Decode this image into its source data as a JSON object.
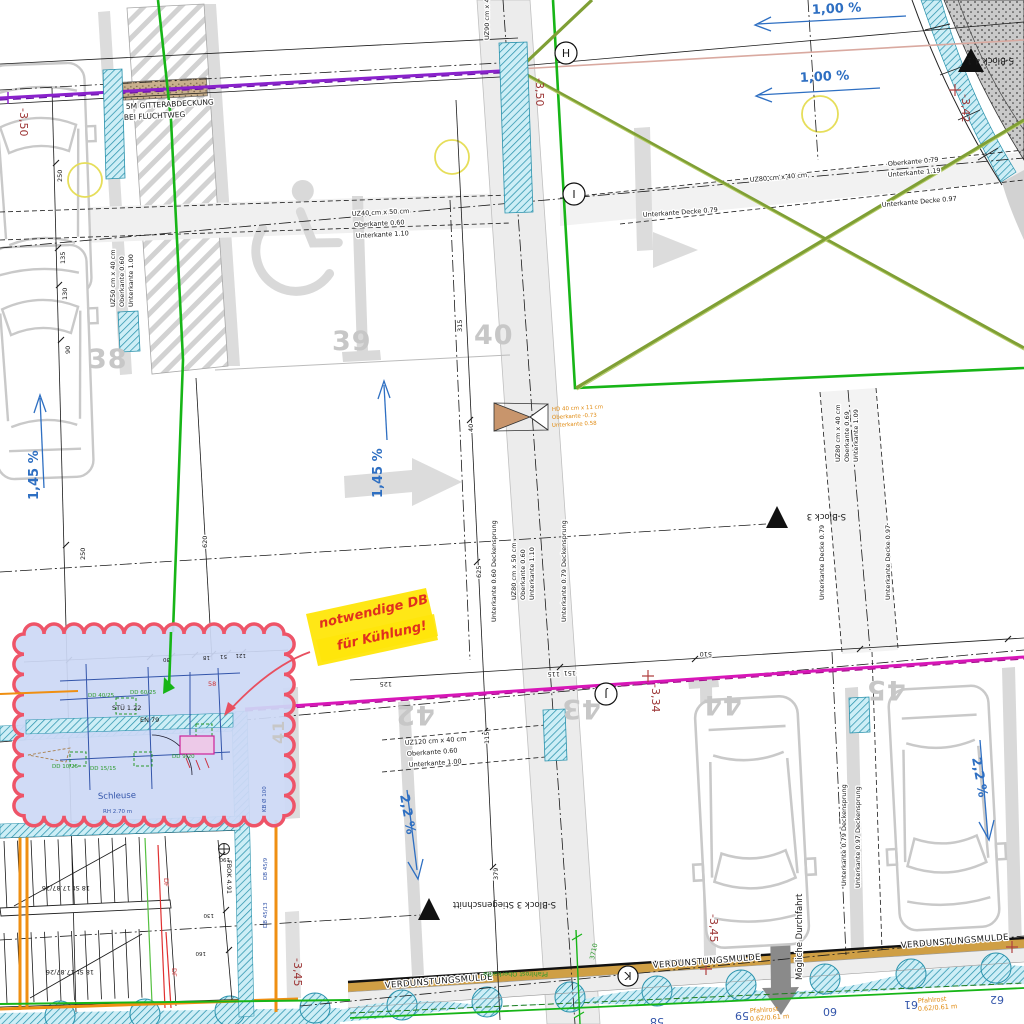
{
  "labels": {
    "gitter1": "5M GITTERABDECKUNG",
    "gitter2": "BEI FLUCHTWEG",
    "slope100a": "1,00 %",
    "slope100b": "1,00 %",
    "slope145a": "1,45 %",
    "slope145b": "1,45 %",
    "slope22a": "2,2 %",
    "slope22b": "2,2 %",
    "lvl350a": "-3,50",
    "lvl350b": "-3,50",
    "lvl342": "-3,42",
    "lvl334": "-3,34",
    "lvl345a": "-3,45",
    "lvl345b": "-3,45",
    "sblock3": "S-Block 3",
    "sblock41": "S-Block 4.1",
    "sblock3st": "S-Block 3 Stiegenschnitt",
    "gridH": "H",
    "gridI": "I",
    "gridJ": "J",
    "gridK": "K",
    "mulde": "VERDUNSTUNGSMULDE",
    "durchfahrt": "Mögliche Durchfahrt",
    "pfahlrost": "Pfahlrost",
    "pfahlrost_dim": "0.62/0.61 m",
    "pfahlrost_ok": "Pfahlrost Oberkante"
  },
  "spots": {
    "n38": "38",
    "n39": "39",
    "n40": "40",
    "n41": "41",
    "n42": "42",
    "n43": "43",
    "n44": "44",
    "n45": "45"
  },
  "mulde_nums": [
    "58",
    "59",
    "60",
    "61",
    "62"
  ],
  "beams": {
    "uz50": [
      "UZ50 cm x 40 cm",
      "Oberkante 0.60",
      "Unterkante 1.00"
    ],
    "uz40": [
      "UZ40 cm x 50 cm",
      "Oberkante 0.60",
      "Unterkante 1.10"
    ],
    "uz90": "UZ90 cm x 40 cm",
    "uz80a": "UZ80 cm x 40 cm",
    "uz80a_ok": "Oberkante 0.79",
    "uz80a_uk": "Unterkante 1.19",
    "ukd079a": "Unterkante Decke 0.79",
    "ukd097a": "Unterkante Decke 0.97",
    "uz80b": [
      "UZ80 cm x 50 cm",
      "Oberkante 0.60",
      "Unterkante 1.10"
    ],
    "ds060": "Unterkante 0.60 Deckensprung",
    "ds079": "Unterkante 0.79 Deckensprung",
    "uz80c": [
      "UZ80 cm x 40 cm",
      "Oberkante 0.69",
      "Unterkante 1.09"
    ],
    "ukd079b": "Unterkante Decke 0.79",
    "ukd097b": "Unterkante Decke 0.97",
    "uz120": [
      "UZ120 cm x 40 cm",
      "Oberkante 0.60",
      "Unterkante 1.00"
    ],
    "ds079b": "Unterkante 0.79 Deckensprung",
    "ds097b": "Unterkante 0.97 Deckensprung",
    "hd": [
      "HD 40 cm x 11 cm",
      "Oberkante -0.73",
      "Unterkante 0.58"
    ]
  },
  "note": {
    "line1": "notwendige DB",
    "line2": "für Kühlung!"
  },
  "cloud": {
    "schleuse": "Schleuse",
    "rh": "RH 2.70 m",
    "stu": "STÜ 1.22",
    "en": "EN 79",
    "r58": "58",
    "kb": "KB Ø 100",
    "dd": [
      "DD 40/25",
      "DD 60/25",
      "DD 15/15",
      "DD 9/20",
      "DD 10/25"
    ]
  },
  "stairs": {
    "steps": "18 St 17.87/26",
    "fbok": "FBOK 4.91",
    "df": "DF",
    "db1": "DB 45/9",
    "db2": "DB 45/13"
  },
  "dims": [
    "250",
    "135",
    "130",
    "90",
    "250",
    "620",
    "315",
    "40",
    "625",
    "115",
    "379",
    "510",
    "125",
    "115",
    "151",
    "30",
    "18",
    "51",
    "121",
    "190",
    "130",
    "160",
    "3710"
  ]
}
